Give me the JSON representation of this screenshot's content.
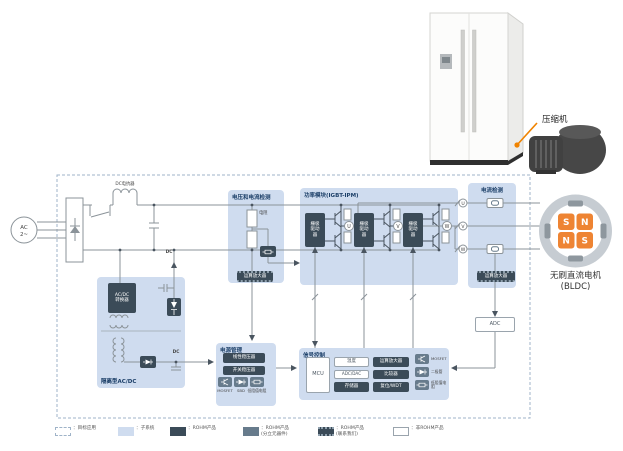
{
  "scene": {
    "compressor_callout": "压缩机"
  },
  "diagram": {
    "ac_source": {
      "line1": "AC",
      "line2": "2~"
    },
    "dc_reactor_label": "DC电抗器",
    "isolated_acdc": {
      "title": "隔离型AC/DC",
      "converter": "AC/DC转换器",
      "dc_label_top": "DC",
      "dc_label_out": "DC"
    },
    "vi_detect": {
      "title": "电压和电流检测",
      "resistor_label": "电阻",
      "opamp_label": "运算放大器"
    },
    "power_module": {
      "title": "功率模块(IGBT-IPM)",
      "gate_driver_label": "栅极驱动器",
      "phases": [
        "U",
        "V",
        "W"
      ]
    },
    "current_detect": {
      "title": "电流检测",
      "opamp_label": "运算放大器",
      "phases": [
        "U",
        "V",
        "W"
      ]
    },
    "adc_label": "ADC",
    "power_mgmt": {
      "title": "电源管理",
      "linear_reg": "线性稳压器",
      "switching_reg": "开关稳压器",
      "components": [
        "MOSFET",
        "SBD",
        "低阻值电阻"
      ]
    },
    "signal_ctrl": {
      "title": "信号控制",
      "mcu": "MCU",
      "temp": "温度",
      "adc_dac": "ADC/DAC",
      "memory": "存储器",
      "opamp": "运算放大器",
      "comparator": "比较器",
      "reset_wdt": "复位/WDT",
      "components": [
        "MOSFET",
        "二极管",
        "低阻值电阻"
      ]
    }
  },
  "motor": {
    "label_line1": "无刷直流电机",
    "label_line2": "(BLDC)",
    "poles": [
      "S",
      "N",
      "N",
      "S"
    ]
  },
  "legend": {
    "items": [
      {
        "label": "：目标应用"
      },
      {
        "label": "：子系统"
      },
      {
        "label": "：ROHM产品"
      },
      {
        "label": "：ROHM产品",
        "sub": "(分立元器件)"
      },
      {
        "label": "：ROHM产品",
        "sub": "(联系我们)"
      },
      {
        "label": "：非ROHM产品"
      }
    ]
  },
  "colors": {
    "accent_orange": "#F08300",
    "subsystem_blue": "#CFDCEF",
    "product_dark": "#3B4B58",
    "product_gray": "#677B8C",
    "title_navy": "#1C3F68",
    "line_gray": "#8B9399"
  }
}
